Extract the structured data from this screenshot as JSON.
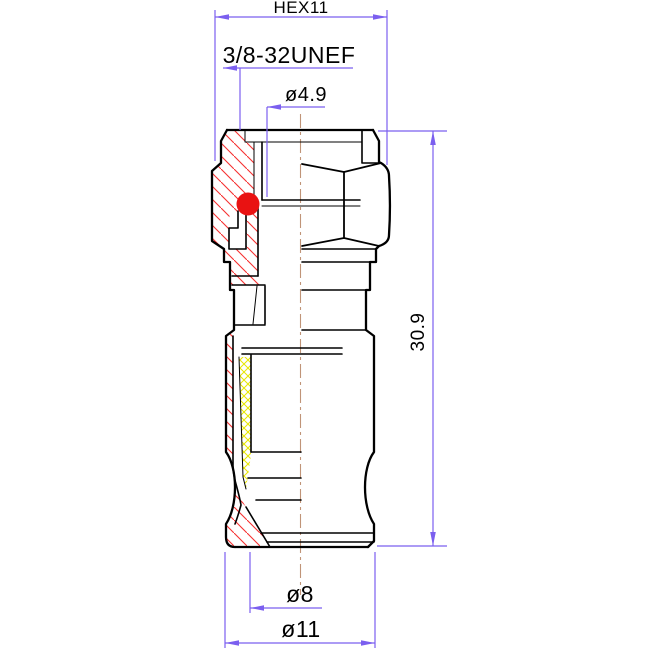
{
  "drawing": {
    "type": "engineering-section-drawing",
    "subject": "coaxial-compression-connector",
    "dimensions": {
      "hex": {
        "label": "HEX11"
      },
      "thread": {
        "label": "3/8-32UNEF"
      },
      "bore_diameter": {
        "label": "ø4.9"
      },
      "overall_height": {
        "label": "30.9"
      },
      "inner_diameter": {
        "label": "ø8"
      },
      "body_diameter": {
        "label": "ø11"
      }
    },
    "colors": {
      "dimension": "#7B5FEF",
      "centerline": "#C09478",
      "section_hatch": "#F53030",
      "insert_hatch": "#E8E600",
      "oring_marker": "#E91212",
      "outline": "#000000",
      "background": "#FFFFFF"
    }
  }
}
